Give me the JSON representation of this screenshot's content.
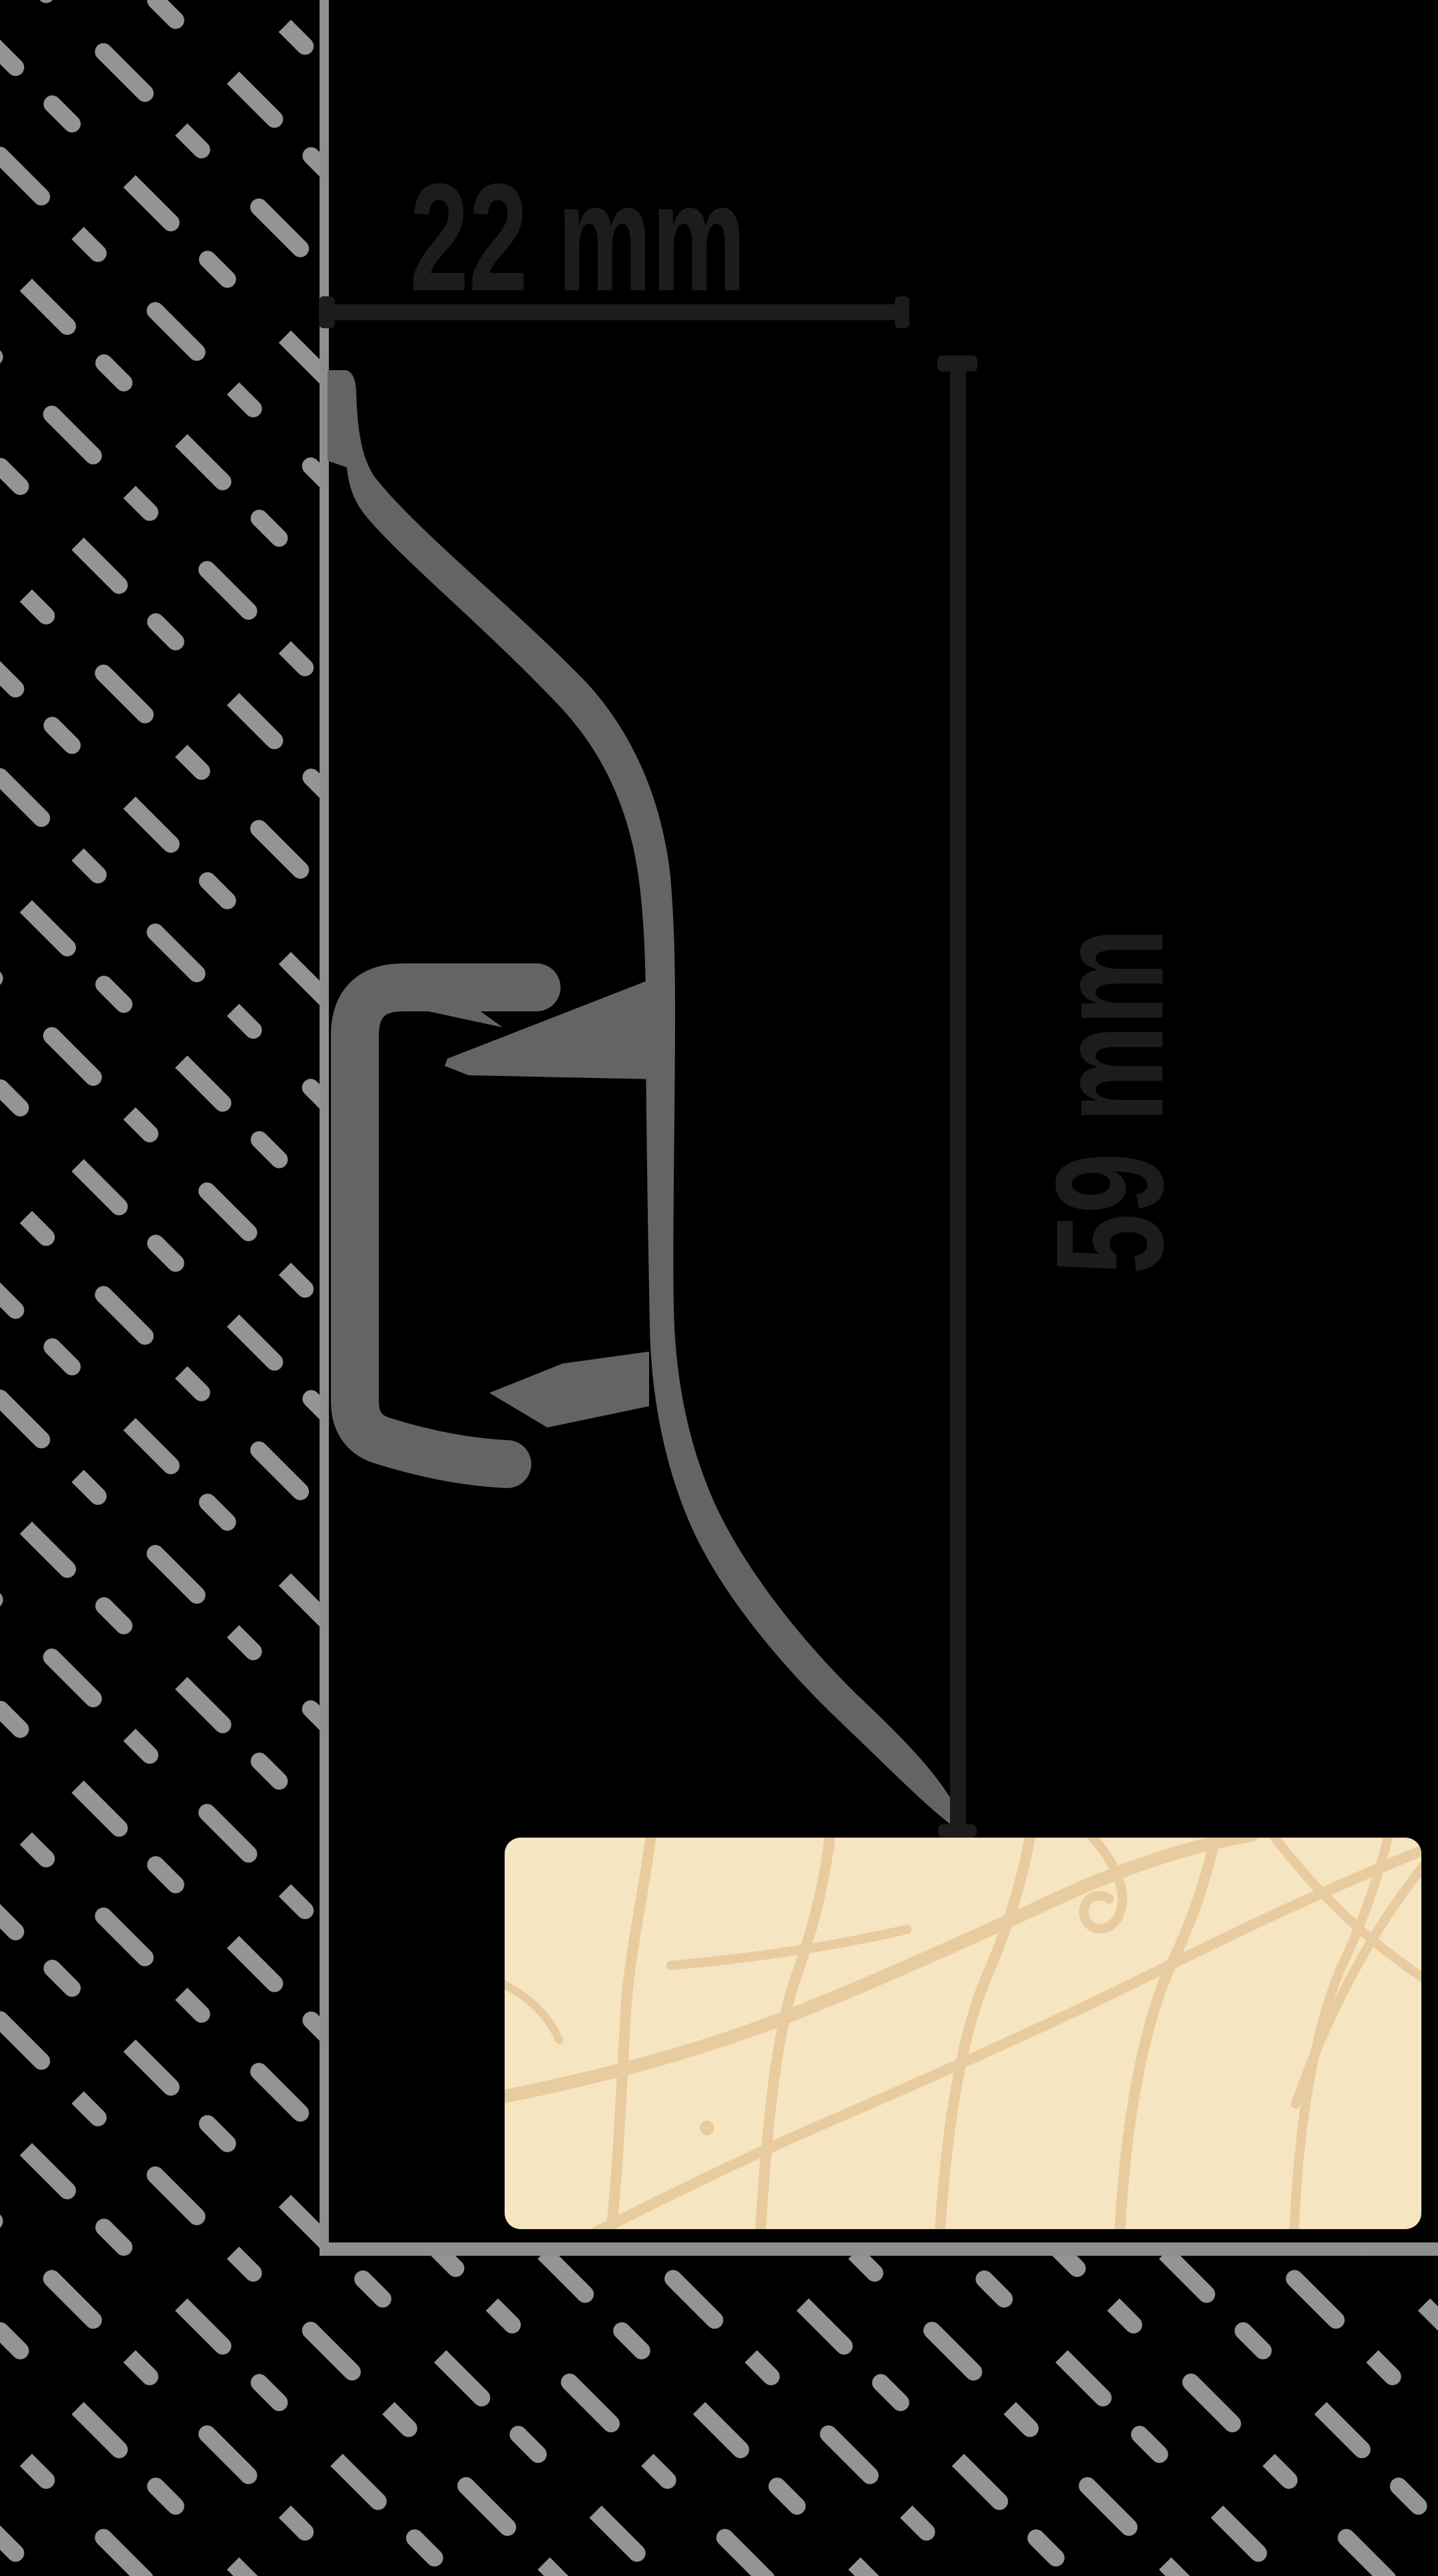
{
  "diagram": {
    "title": "Skirting board profile cross-section mounted on wall above floor board",
    "type": "technical-dimension-drawing",
    "dimensions": {
      "width_label": "22 mm",
      "height_label": "59 mm"
    },
    "colors": {
      "background": "#000000",
      "hatch": "#949494",
      "wall_line": "#8f8f8f",
      "floor_line": "#8f8f8f",
      "profile": "#646464",
      "dimension": "#1e1c1a",
      "floor_fill": "#f5e5c1",
      "floor_grain": "#e8cb9e"
    }
  }
}
